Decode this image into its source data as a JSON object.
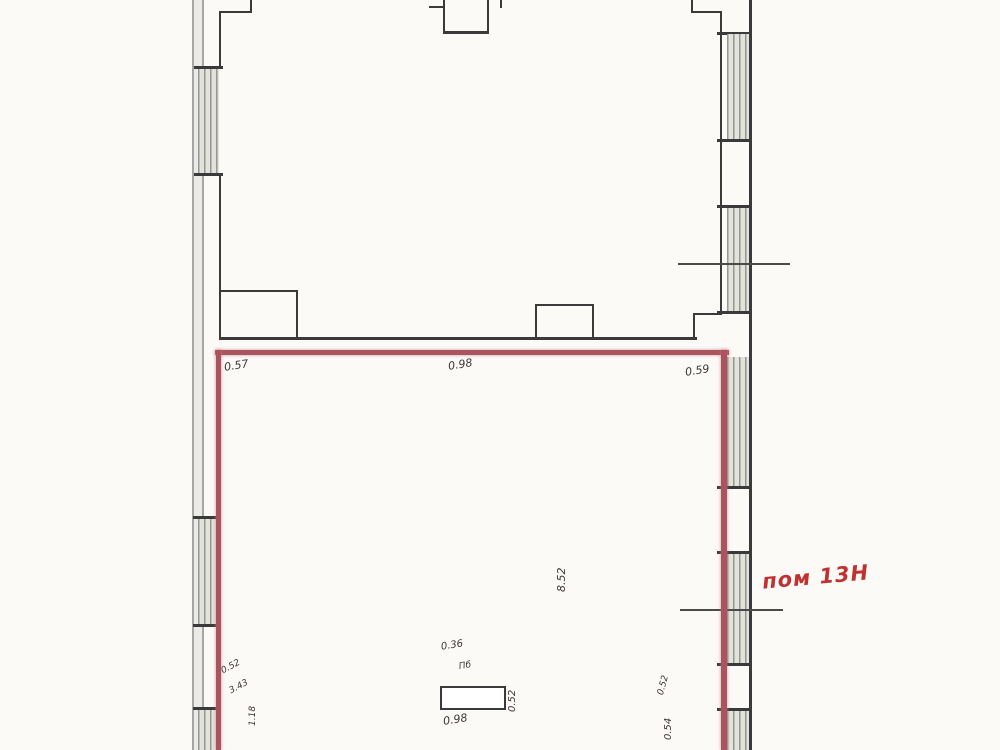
{
  "plan": {
    "room_label": "пом 13Н",
    "dimensions": {
      "divider_left": "0.57",
      "divider_center": "0.98",
      "divider_right": "0.59",
      "room_length_vertical": "8.52",
      "stove_top": "0.36",
      "stove_tag": "Пб",
      "stove_side_vertical": "0.52",
      "stove_bottom": "0.98",
      "bottom_left_upper": "0.52",
      "bottom_left_lower": "3.43",
      "bottom_left_vertical": "1.18",
      "bottom_right_upper": "0.52",
      "bottom_right_vertical": "0.54"
    },
    "colors": {
      "wall_black": "#3a3a3a",
      "wall_gray": "#a6a6a2",
      "window_hatch": "#96968e",
      "room_outline_red": "#a9545e",
      "room_label_red": "#c03232",
      "dimension_text": "#3f3539"
    }
  }
}
